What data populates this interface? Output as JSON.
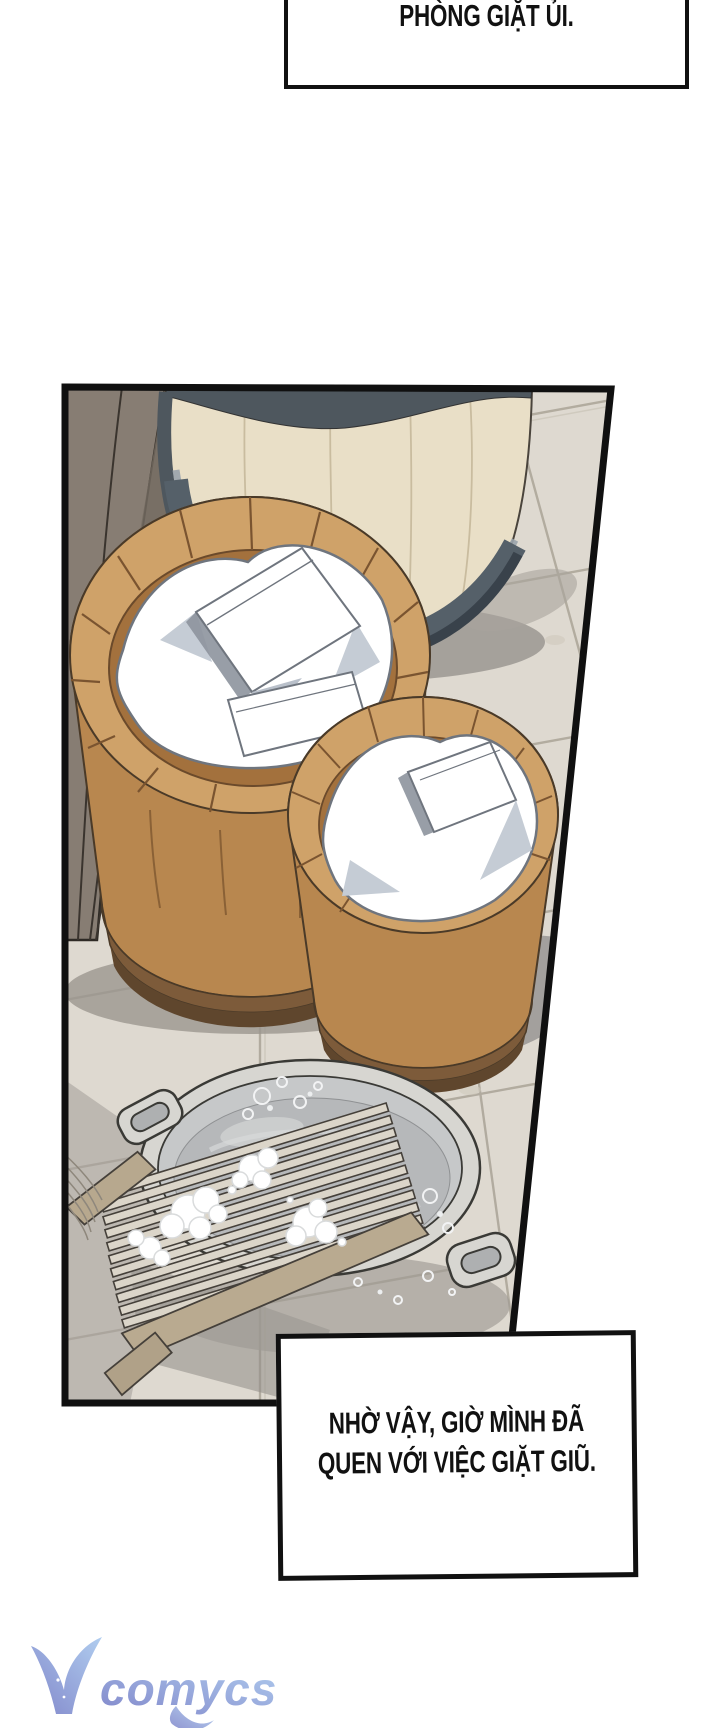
{
  "narration": {
    "top": {
      "text": "PHÒNG GIẶT ỦI."
    },
    "bottom": {
      "line1": "NHỜ VẬY, GIỜ MÌNH ĐÃ",
      "line2": "QUEN VỚI VIỆC GIẶT GIŨ."
    }
  },
  "watermark": {
    "v": "V",
    "rest": "comycs",
    "gradient": [
      "#8288cb",
      "#b0cdef"
    ]
  },
  "panel": {
    "scene": "laundry room: two wooden wash basins filled with white laundry, a large pale wooden barrel, a metal tub of soapy water with a washboard, on a stone tile floor beside a dark plank walkway",
    "colors": {
      "ink": "#101010",
      "tile": "#ded9d0",
      "grout": "#a39c8f",
      "walkway": "#877d73",
      "barrel_stave": "#e9dfc7",
      "hoop_dark": "#4e575e",
      "wood_light": "#cfa269",
      "wood_mid": "#b8874f",
      "wood_inner": "#a3713d",
      "laundry": "#ffffff",
      "laundry_shadow": "#c5ccd5",
      "metal_rim": "#d7d6d1",
      "water": "#b6b8ba",
      "foam": "#ffffff",
      "washboard_slat": "#dbd5c9",
      "washboard_rail": "#b9aa90"
    }
  }
}
